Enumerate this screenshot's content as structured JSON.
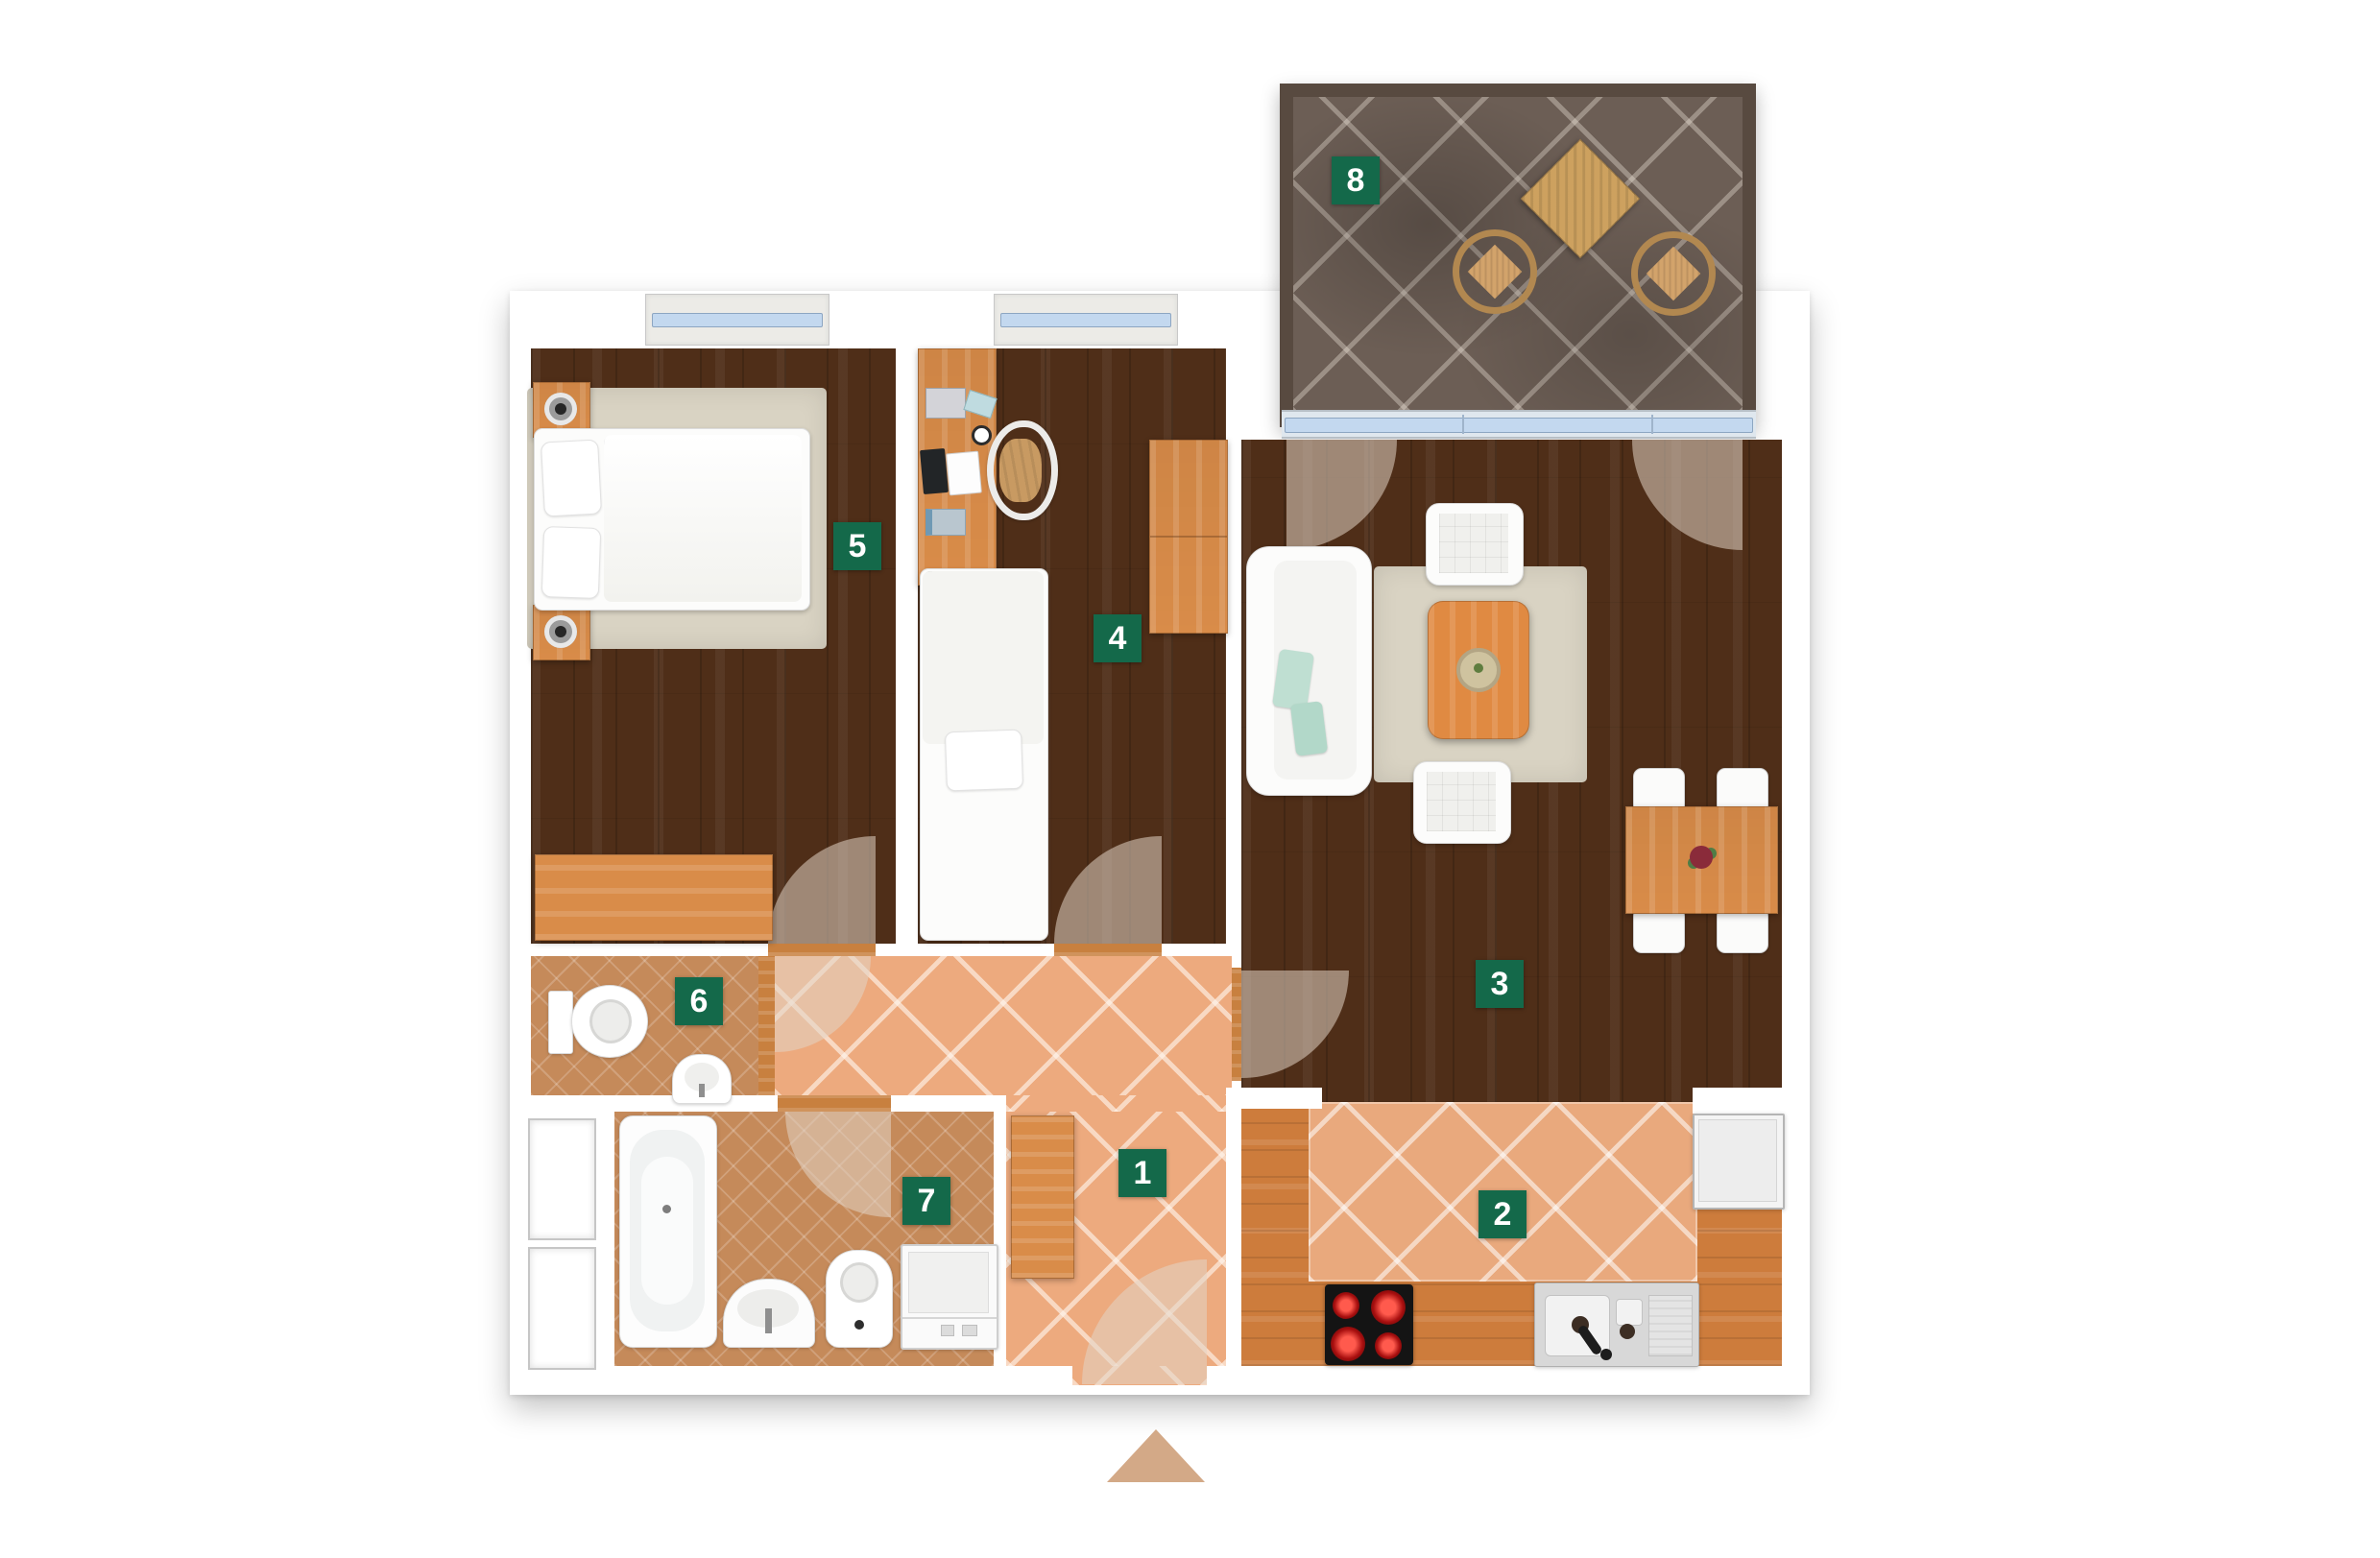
{
  "plan": {
    "room_labels": [
      {
        "number": "1"
      },
      {
        "number": "2"
      },
      {
        "number": "3"
      },
      {
        "number": "4"
      },
      {
        "number": "5"
      },
      {
        "number": "6"
      },
      {
        "number": "7"
      },
      {
        "number": "8"
      }
    ],
    "icons": {
      "entrance_arrow": "triangle-up"
    },
    "colors": {
      "label_bg": "#14694a",
      "label_text": "#ffffff",
      "dark_wood_floor": "#4f2e18",
      "hall_tile": "#edaa7e",
      "wet_room_tile": "#c58a5a",
      "balcony_tile": "#6c5e55",
      "furniture_wood": "#d98c49",
      "kitchen_wood": "#cd7c3c",
      "glass": "#c3d8ef",
      "rug": "#d9d3c3",
      "door_swing": "#e2d3c5",
      "entrance_arrow": "#d3a987"
    }
  }
}
